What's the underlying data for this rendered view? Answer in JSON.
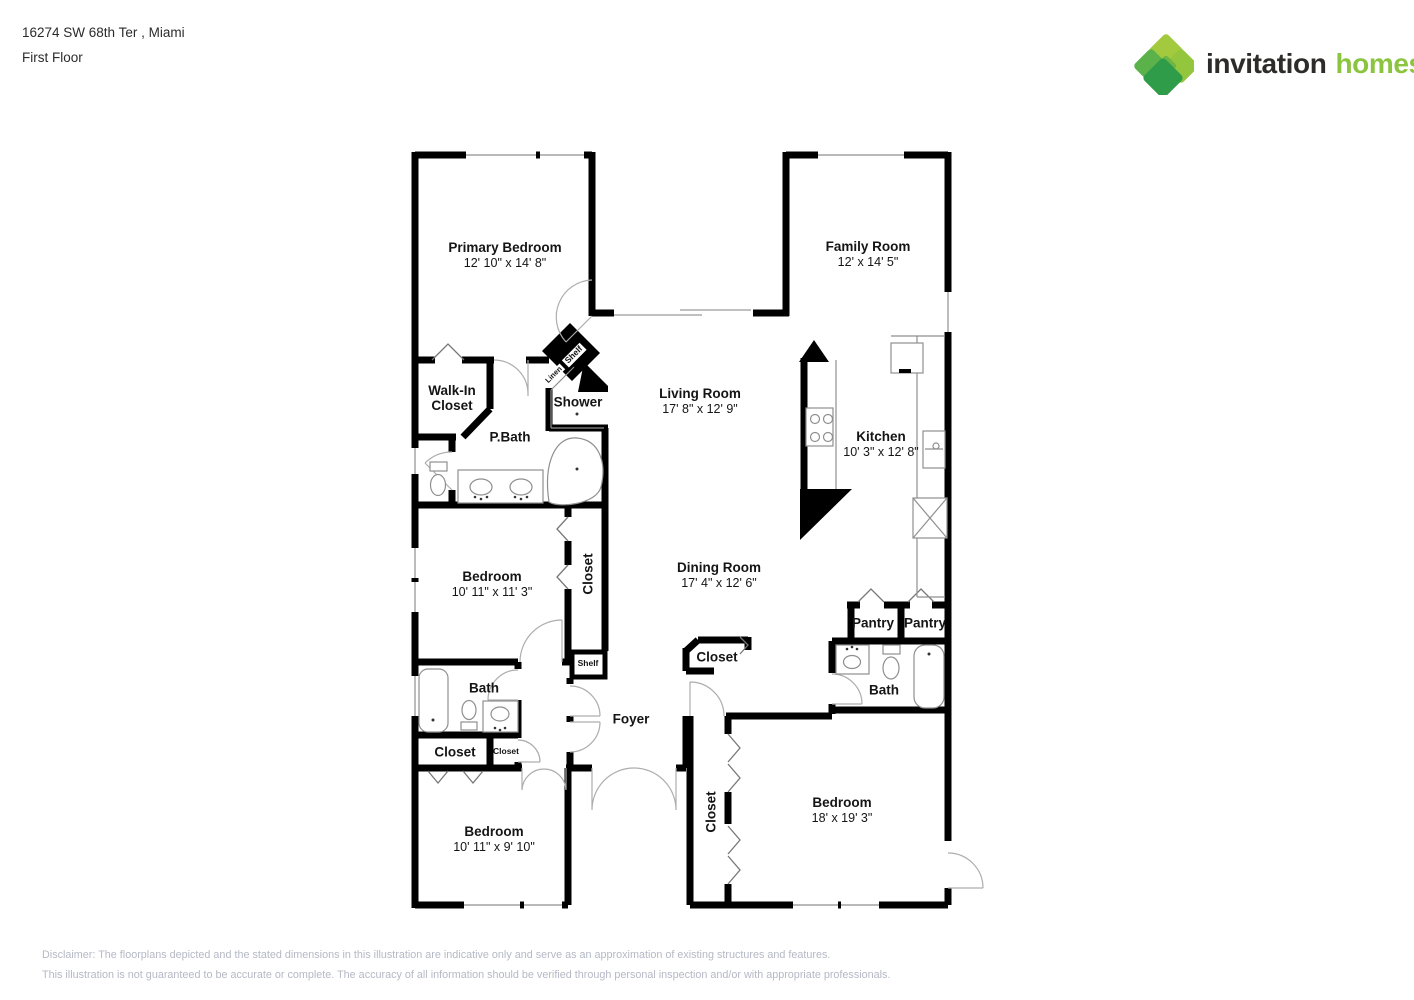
{
  "header": {
    "address_line": "16274 SW 68th Ter , Miami",
    "floor_line": "First Floor"
  },
  "logo": {
    "brand_word1": "invitation",
    "brand_word2": "homes",
    "trademark": "™",
    "word1_color": "#2d2c2b",
    "word2_color": "#8bc53f",
    "diamond_colors": [
      "#a3ca3e",
      "#93c53d",
      "#5bb24b",
      "#6db544",
      "#2e9c49"
    ]
  },
  "floorplan": {
    "labels": [
      {
        "id": "primary-bedroom",
        "name": "Primary Bedroom",
        "dims": "12' 10\" x 14' 8\"",
        "x": 505,
        "y": 255,
        "size": "lg"
      },
      {
        "id": "family-room",
        "name": "Family Room",
        "dims": "12' x 14' 5\"",
        "x": 868,
        "y": 254,
        "size": "lg"
      },
      {
        "id": "walk-in-closet",
        "name": "Walk-In\nCloset",
        "x": 452,
        "y": 398,
        "size": "lg"
      },
      {
        "id": "shower",
        "name": "Shower",
        "x": 578,
        "y": 402,
        "size": "lg"
      },
      {
        "id": "p-bath",
        "name": "P.Bath",
        "x": 510,
        "y": 437,
        "size": "lg"
      },
      {
        "id": "living-room",
        "name": "Living Room",
        "dims": "17' 8\" x 12' 9\"",
        "x": 700,
        "y": 401,
        "size": "lg"
      },
      {
        "id": "kitchen",
        "name": "Kitchen",
        "dims": "10' 3\" x 12' 8\"",
        "x": 881,
        "y": 444,
        "size": "lg"
      },
      {
        "id": "bedroom-2",
        "name": "Bedroom",
        "dims": "10' 11\" x 11' 3\"",
        "x": 492,
        "y": 584,
        "size": "lg"
      },
      {
        "id": "closet-bedroom-2",
        "name": "Closet",
        "x": 588,
        "y": 574,
        "size": "lg",
        "rot": -90
      },
      {
        "id": "dining-room",
        "name": "Dining Room",
        "dims": "17' 4\" x 12' 6\"",
        "x": 719,
        "y": 575,
        "size": "lg"
      },
      {
        "id": "pantry-left",
        "name": "Pantry",
        "x": 873,
        "y": 623,
        "size": "lg"
      },
      {
        "id": "pantry-right",
        "name": "Pantry",
        "x": 925,
        "y": 623,
        "size": "lg"
      },
      {
        "id": "closet-dining",
        "name": "Closet",
        "x": 717,
        "y": 657,
        "size": "lg"
      },
      {
        "id": "bath-hall",
        "name": "Bath",
        "x": 484,
        "y": 688,
        "size": "lg"
      },
      {
        "id": "bath-right",
        "name": "Bath",
        "x": 884,
        "y": 690,
        "size": "lg"
      },
      {
        "id": "closet-hall",
        "name": "Closet",
        "x": 455,
        "y": 752,
        "size": "lg"
      },
      {
        "id": "closet-small",
        "name": "Closet",
        "x": 506,
        "y": 752,
        "size": "xs"
      },
      {
        "id": "foyer",
        "name": "Foyer",
        "x": 631,
        "y": 719,
        "size": "lg"
      },
      {
        "id": "shelf-foyer",
        "name": "Shelf",
        "x": 588,
        "y": 664,
        "size": "xs"
      },
      {
        "id": "shelf-linen",
        "name": "Shelf",
        "x": 574,
        "y": 355,
        "size": "xs",
        "rot": -45,
        "chip": true
      },
      {
        "id": "linen",
        "name": "Linen",
        "x": 554,
        "y": 375,
        "size": "xxs",
        "rot": -45,
        "chip": true
      },
      {
        "id": "bedroom-3",
        "name": "Bedroom",
        "dims": "10' 11\" x 9' 10\"",
        "x": 494,
        "y": 839,
        "size": "lg"
      },
      {
        "id": "closet-bedroom-4",
        "name": "Closet",
        "x": 711,
        "y": 812,
        "size": "lg",
        "rot": -90
      },
      {
        "id": "bedroom-4",
        "name": "Bedroom",
        "dims": "18' x 19' 3\"",
        "x": 842,
        "y": 810,
        "size": "lg"
      }
    ]
  },
  "disclaimer": {
    "line1": "Disclaimer: The floorplans depicted and the stated dimensions in this illustration are indicative only and serve as an approximation of existing structures and features.",
    "line2": "This illustration is not guaranteed to be accurate or complete. The accuracy of all information should be verified through personal inspection and/or with appropriate professionals."
  }
}
